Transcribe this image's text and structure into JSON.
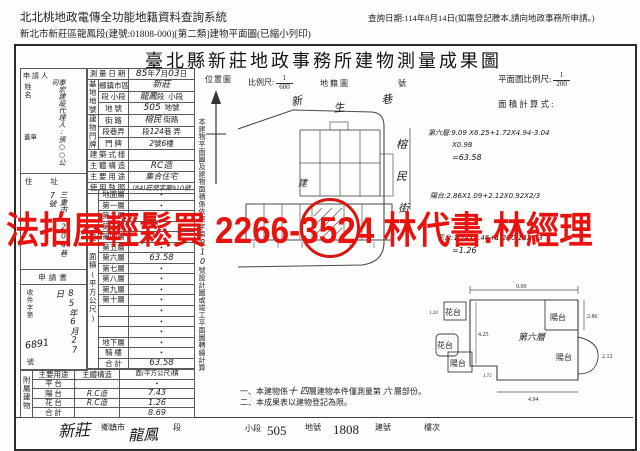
{
  "header": {
    "system_title": "北北桃地政電傳全功能地籍資料查詢系統",
    "query_note": "查詢日期:114年8月14日(如需登記謄本,請向地政事務所申請。)",
    "print_title": "新北市新莊區龍鳳段(建號:01808-000)[第二類]建物平面圖(已縮小列印)"
  },
  "banner": {
    "text": "法拍屋輕鬆買 2266-3524 林代書.林經理",
    "color": "#e8120e"
  },
  "doc": {
    "title": "臺北縣新莊地政事務所建物測量成果圖",
    "survey_date": {
      "label": "測 量 日 期",
      "y": "85",
      "yu": "年",
      "m": "7",
      "mu": "月",
      "d": "03",
      "du": "日"
    },
    "site": {
      "group": "基地地號",
      "district_label": "鄉鎮市區",
      "district": "新莊",
      "section_label": "段 小段",
      "section_hw": "龍鳳",
      "section_mid": "段",
      "subsection": "小段",
      "parcel_label": "地 號",
      "parcel_hw": "505",
      "parcel_suffix": "地號"
    },
    "premises": {
      "group": "建物門牌",
      "street_label": "街 路",
      "street_hw": "榕民",
      "street_suffix": "街路",
      "lane_label": "段巷弄",
      "lane_p1": "段",
      "lane_hw": "124",
      "lane_p2": "巷",
      "lane_p3": "弄",
      "door_label": "門 牌",
      "door_hw1": "2",
      "door_p1": "號",
      "door_hw2": "6",
      "door_p2": "樓"
    },
    "style": {
      "label": "建 築 式 樣",
      "value": ""
    },
    "structure": {
      "label": "主 體 構 造",
      "value": "RC造"
    },
    "usage": {
      "label": "主 要 用 途",
      "value": "集合住宅"
    },
    "license": {
      "label": "使 用 執 照",
      "value": "(84)莊使字第910號"
    },
    "floors": {
      "group": "建 面積(平方公尺)",
      "rows": [
        {
          "label": "地面層",
          "value": "•"
        },
        {
          "label": "第一層",
          "value": "•"
        },
        {
          "label": "第二層",
          "value": "•"
        },
        {
          "label": "第三層",
          "value": "•"
        },
        {
          "label": "第四層",
          "value": "•"
        },
        {
          "label": "第五層",
          "value": "•"
        },
        {
          "label": "第六層",
          "value": "63.58"
        },
        {
          "label": "第七層",
          "value": "•"
        },
        {
          "label": "第八層",
          "value": "•"
        },
        {
          "label": "第九層",
          "value": "•"
        },
        {
          "label": "第十層",
          "value": "•"
        },
        {
          "label": "",
          "value": "•"
        },
        {
          "label": "",
          "value": "•"
        },
        {
          "label": "",
          "value": "•"
        },
        {
          "label": "地下層",
          "value": "•"
        },
        {
          "label": "騎 樓",
          "value": "•"
        },
        {
          "label": "合 計",
          "value": "63.58"
        }
      ]
    },
    "annex": {
      "group": "附屬建物",
      "h_use": "主要用途",
      "h_struct": "主體構造",
      "h_area": "面(平方公尺)積",
      "rows": [
        {
          "use": "平 台",
          "structure": "",
          "area": "•"
        },
        {
          "use": "陽 台",
          "structure": "R.C造",
          "area": "7.43"
        },
        {
          "use": "花 台",
          "structure": "R.C造",
          "area": "1.26"
        },
        {
          "use": "合 計",
          "structure": "",
          "area": "8.69"
        }
      ]
    },
    "applicant": {
      "group": "申請人",
      "name_label": "姓名",
      "name_hw": "泰宏建設代理人:張○○公司",
      "seal": "蓋章",
      "address_label": "住 址",
      "address_hw": "三重市…204巷7號",
      "form_label": "申請書",
      "intake_label": "收件字第",
      "intake_no": "6891",
      "intake_no_suffix": "號",
      "intake_date": "85年6月27日"
    },
    "side_note": {
      "pre": "本建物平面圖及建物面積係依使字第",
      "hw": "910",
      "post": "號設計圖或竣工平面圖轉繪計算"
    },
    "location_map": {
      "label": "位置圖",
      "scale_label": "比例尺:",
      "num": "1",
      "den": "600",
      "cadastral": "地籍圖",
      "sheet": "號",
      "street_top_1": "新",
      "street_top_2": "生",
      "street_top_3": "巷",
      "street_right_1": "榕",
      "street_right_2": "民",
      "street_right_3": "街",
      "bldg": "建"
    },
    "plan": {
      "scale_label": "平面圖比例尺:",
      "num": "1",
      "den": "200",
      "calc_label": "面 積 計 算 式 :",
      "calc1": "第六層:9.09 X6.25+1.72X4.94-3.04",
      "calc2": "X0.98",
      "calc3": "=63.58",
      "calc4": "陽台:2.86X1.09+2.12X0.92X2/3",
      "calc5": "花台:1.24X0.46+1.2X0.18X1/3",
      "calc6": "=1.26",
      "floor": "第六層",
      "balcony": "陽台",
      "planter": "花台",
      "d_top": "9.09",
      "d_r1": "2.86",
      "d_r2": "2.12",
      "d_left": "4.25",
      "d_bottom": "4.94",
      "d_step": "1.72",
      "d_fl": "1.24"
    },
    "notes": {
      "n1a": "一、本建物係",
      "n1b": "十 四",
      "n1c": "層建物本件僅測量第 ",
      "n1d": "六",
      "n1e": " 層部份。",
      "n2": "二、本成果表以建物登記為限。"
    },
    "footer": {
      "town_hw": "新莊",
      "town": "鄉鎮市",
      "section_hw": "龍鳳",
      "section": "段",
      "subsection": "小段",
      "parcel": "505",
      "parcel_label": "地號",
      "building_no": "1808",
      "building_label": "建號",
      "floor_label": "樓次"
    }
  }
}
